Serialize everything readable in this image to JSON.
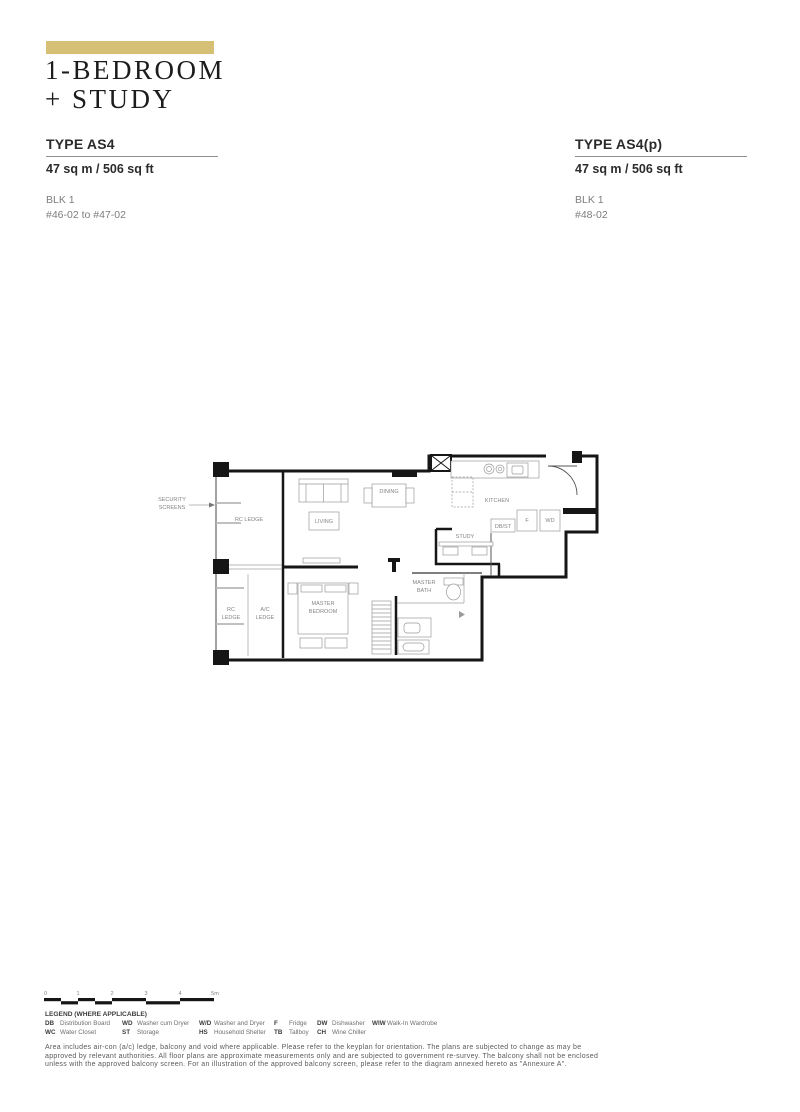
{
  "header": {
    "accent_color": "#d5c076",
    "title_line1": "1-BEDROOM",
    "title_line2": "+ STUDY"
  },
  "units": [
    {
      "type": "TYPE AS4",
      "area": "47 sq m / 506 sq ft",
      "block": "BLK 1",
      "stacks": "#46-02 to #47-02"
    },
    {
      "type": "TYPE AS4(p)",
      "area": "47 sq m / 506 sq ft",
      "block": "BLK 1",
      "stacks": "#48-02"
    }
  ],
  "floorplan": {
    "labels": {
      "security_screens": [
        "SECURITY",
        "SCREENS"
      ],
      "rc_ledge_top": "RC LEDGE",
      "rc_ledge_bottom": [
        "RC",
        "LEDGE"
      ],
      "ac_ledge": [
        "A/C",
        "LEDGE"
      ],
      "living": "LIVING",
      "dining": "DINING",
      "kitchen": "KITCHEN",
      "study": "STUDY",
      "db_st": "DB/ST",
      "fridge": "F",
      "washer_dryer": "WD",
      "master_bedroom": [
        "MASTER",
        "BEDROOM"
      ],
      "master_bath": [
        "MASTER",
        "BATH"
      ]
    }
  },
  "scale_bar": {
    "ticks": [
      "0",
      "1",
      "2",
      "3",
      "4",
      "5m"
    ]
  },
  "legend": {
    "title": "LEGEND (WHERE APPLICABLE)",
    "rows": [
      [
        {
          "abbr": "DB",
          "desc": "Distribution Board"
        },
        {
          "abbr": "WD",
          "desc": "Washer cum Dryer"
        },
        {
          "abbr": "W/D",
          "desc": "Washer and Dryer"
        },
        {
          "abbr": "F",
          "desc": "Fridge"
        },
        {
          "abbr": "DW",
          "desc": "Dishwasher"
        },
        {
          "abbr": "WIW",
          "desc": "Walk-In Wardrobe"
        }
      ],
      [
        {
          "abbr": "WC",
          "desc": "Water Closet"
        },
        {
          "abbr": "ST",
          "desc": "Storage"
        },
        {
          "abbr": "HS",
          "desc": "Household Shelter"
        },
        {
          "abbr": "TB",
          "desc": "Tallboy"
        },
        {
          "abbr": "CH",
          "desc": "Wine Chiller"
        }
      ]
    ]
  },
  "disclaimer": {
    "line1": "Area includes air-con (a/c) ledge, balcony and void where applicable. Please refer to the keyplan for orientation. The plans are subjected to change as may be",
    "line2": "approved by relevant authorities. All floor plans are approximate measurements only and are subjected to government re-survey. The balcony shall not be enclosed",
    "line3": "unless with the approved balcony screen. For an illustration of the approved balcony screen, please refer to the diagram annexed hereto as \"Annexure A\"."
  }
}
